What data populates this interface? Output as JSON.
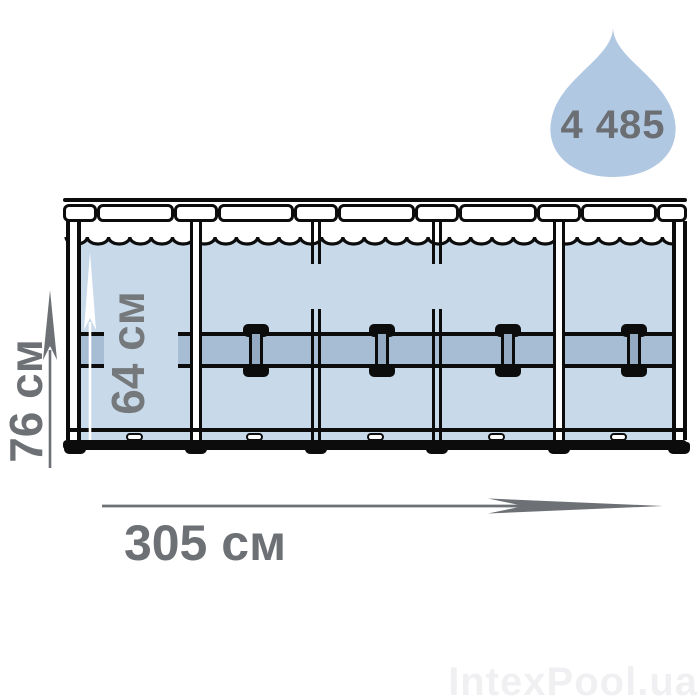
{
  "diagram": {
    "title_semantics": "frame pool dimensions diagram",
    "capacity": {
      "value": "4 485",
      "icon": "water-drop-icon"
    },
    "dimensions": {
      "width": "305 см",
      "height": "76 см",
      "water_depth": "64 см"
    },
    "watermark": "IntexPool.ua",
    "colors": {
      "water": "#c8d9ea",
      "band": "#a7bdd3",
      "connector_stem": "#93aac2",
      "drop": "#b1c8e3",
      "outline": "#0c0c0c",
      "label_gray": "#6d7074",
      "watermark_gray": "#f0f0f2"
    }
  }
}
